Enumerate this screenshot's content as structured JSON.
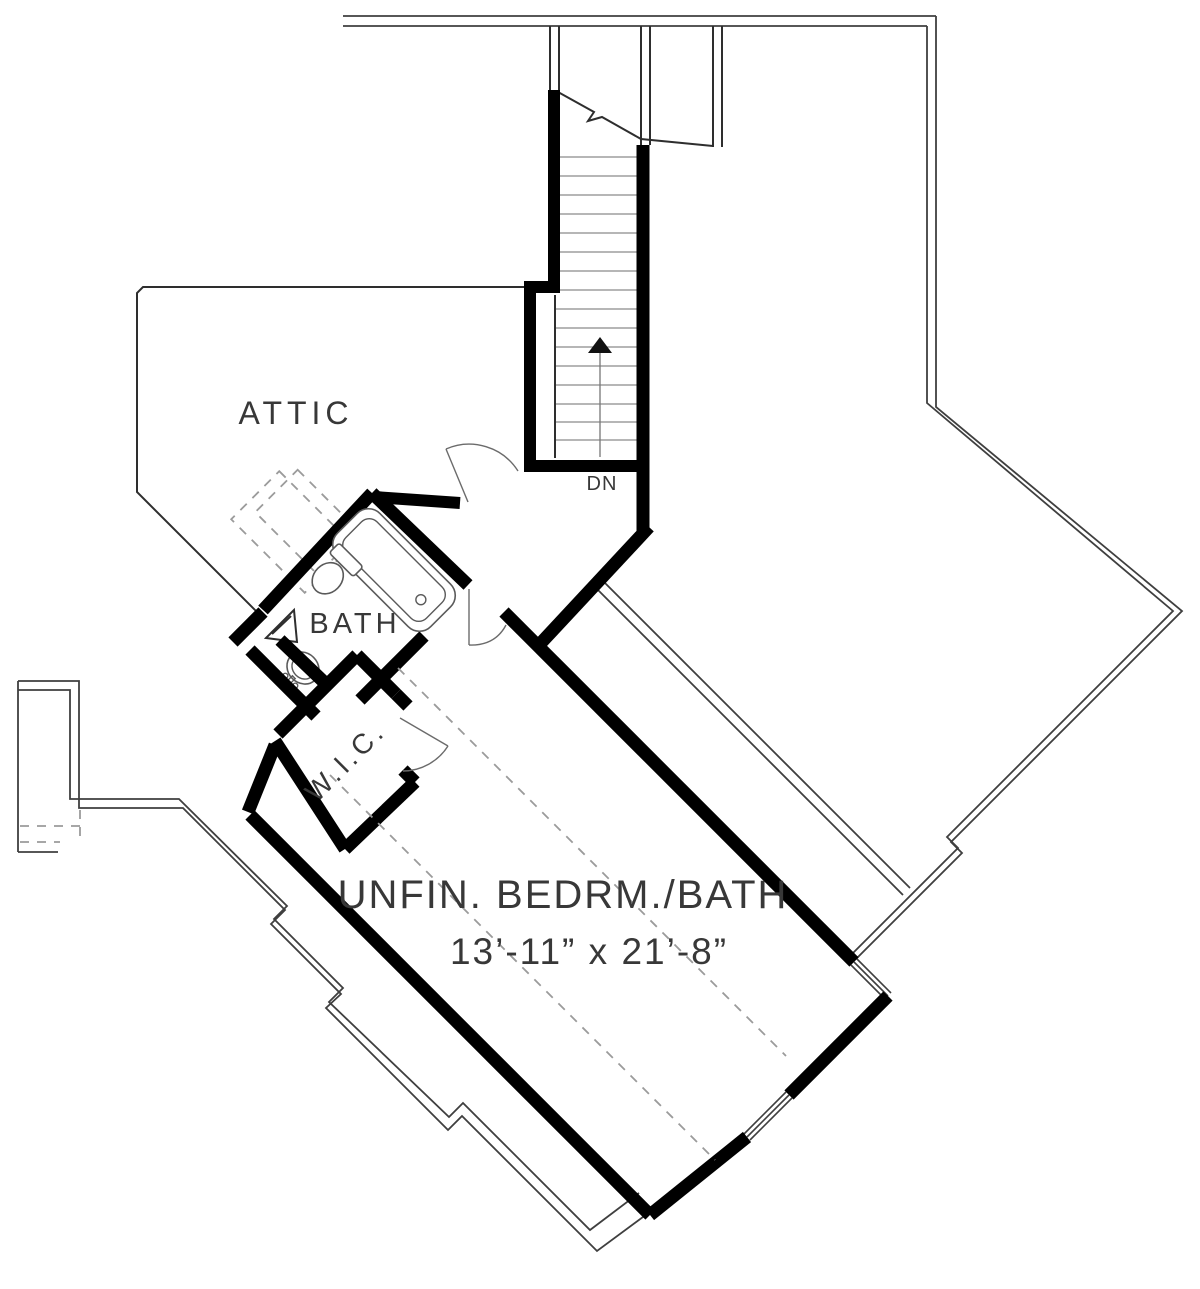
{
  "document": {
    "type": "architectural-floor-plan",
    "view": "upper-floor-plan"
  },
  "palette": {
    "wall": "#000000",
    "thin_line": "#2e2e2e",
    "roof_line": "#3f3f3f",
    "dashed_line": "#9b9b9b",
    "fixture_line": "#5a5a5a",
    "text": "#383838",
    "background": "#ffffff"
  },
  "labels": {
    "attic": "ATTIC",
    "bath": "BATH",
    "wic": "W.I.C.",
    "bedroom_name": "UNFIN.  BEDRM./BATH",
    "bedroom_dims": "13’-11” x 21’-8”",
    "stair_direction": "DN"
  },
  "rooms": [
    {
      "name": "attic"
    },
    {
      "name": "bath",
      "fixtures": [
        "tub",
        "toilet",
        "sink"
      ]
    },
    {
      "name": "walk-in-closet"
    },
    {
      "name": "unfinished-bedroom-bath",
      "dimensions": "13’-11” x 21’-8”"
    },
    {
      "name": "stairwell",
      "direction": "DN"
    }
  ]
}
